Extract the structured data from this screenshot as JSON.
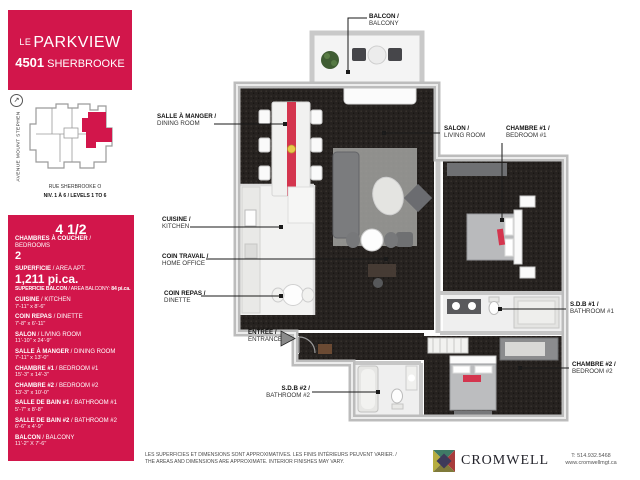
{
  "header": {
    "le": "LE",
    "name": "PARKVIEW",
    "number": "4501",
    "street": "SHERBROOKE"
  },
  "sitemap": {
    "avenue": "AVENUE MOUNT STEPHEN",
    "street": "RUE SHERBROOKE O",
    "levels": "NIV. 1 À 6 / LEVELS 1 TO 6",
    "compass_icon": "north-east-arrow"
  },
  "stats": {
    "unit_type": "4 1/2",
    "bedrooms_fr": "CHAMBRES À COUCHER",
    "bedrooms_en": " / BEDROOMS",
    "bedrooms_value": "2",
    "area_fr": "SUPERFICIE",
    "area_en": " / AREA APT.",
    "area_value": "1,211 pi.ca.",
    "balcony_fr": "SUPERFICIE BALCON",
    "balcony_en": " / AREA BALCONY: ",
    "balcony_value": "84 pi.ca.",
    "rooms": [
      {
        "fr": "CUISINE",
        "en": " / KITCHEN",
        "dim": "7'-11\" x 8'-6\""
      },
      {
        "fr": "COIN REPAS",
        "en": " / DINETTE",
        "dim": "7'-8\" x 6'-11\""
      },
      {
        "fr": "SALON",
        "en": " / LIVING ROOM",
        "dim": "11'-10\" x 24'-9\""
      },
      {
        "fr": "SALLE À MANGER",
        "en": " / DINING ROOM",
        "dim": "7'-11\" x 13'-0\""
      },
      {
        "fr": "CHAMBRE #1",
        "en": " / BEDROOM #1",
        "dim": "15'-3\" x 14'-3\""
      },
      {
        "fr": "CHAMBRE #2",
        "en": " / BEDROOM #2",
        "dim": "13'-3\" x 10'-0\""
      },
      {
        "fr": "SALLE DE BAIN #1",
        "en": " / BATHROOM #1",
        "dim": "5'-7\" x 8'-8\""
      },
      {
        "fr": "SALLE DE BAIN #2",
        "en": " / BATHROOM #2",
        "dim": "6'-6\" x 4'-9\""
      },
      {
        "fr": "BALCON",
        "en": " / BALCONY",
        "dim": "11'-2\" X 7'-6\""
      }
    ]
  },
  "plan": {
    "balcony": {
      "fr": "BALCON /",
      "en": "BALCONY"
    },
    "dining": {
      "fr": "SALLE À MANGER /",
      "en": "DINING ROOM"
    },
    "salon": {
      "fr": "SALON /",
      "en": "LIVING ROOM"
    },
    "bedroom1": {
      "fr": "CHAMBRE #1 /",
      "en": "BEDROOM #1"
    },
    "kitchen": {
      "fr": "CUISINE /",
      "en": "KITCHEN"
    },
    "office": {
      "fr": "COIN TRAVAIL /",
      "en": "HOME OFFICE"
    },
    "dinette": {
      "fr": "COIN REPAS /",
      "en": "DINETTE"
    },
    "entrance": {
      "fr": "ENTRÉE /",
      "en": "ENTRANCE"
    },
    "bath1": {
      "fr": "S.D.B #1 /",
      "en": "BATHROOM #1"
    },
    "bedroom2": {
      "fr": "CHAMBRE #2 /",
      "en": "BEDROOM #2"
    },
    "bath2": {
      "fr": "S.D.B #2 /",
      "en": "BATHROOM #2"
    }
  },
  "footer": {
    "disclaimer_fr": "LES SUPERFICIES ET DIMENSIONS SONT APPROXIMATIVES. LES FINIS INTÉRIEURS PEUVENT VARIER. /",
    "disclaimer_en": "THE AREAS AND DIMENSIONS ARE APPROXIMATE. INTERIOR FINISHES MAY VARY.",
    "brand": "CROMWELL",
    "phone": "T: 514.932.5468",
    "website": "www.cromwellmgt.ca"
  },
  "colors": {
    "accent": "#d2164b",
    "furniture_red": "#d4354e",
    "carpet": "#262220",
    "wall": "#bcbcbc",
    "logo_teal": "#3f7a66",
    "logo_red": "#a83c3c",
    "logo_yellow": "#b6ad3f",
    "logo_olive": "#7f7a3a",
    "logo_navy": "#3d3a5a"
  }
}
